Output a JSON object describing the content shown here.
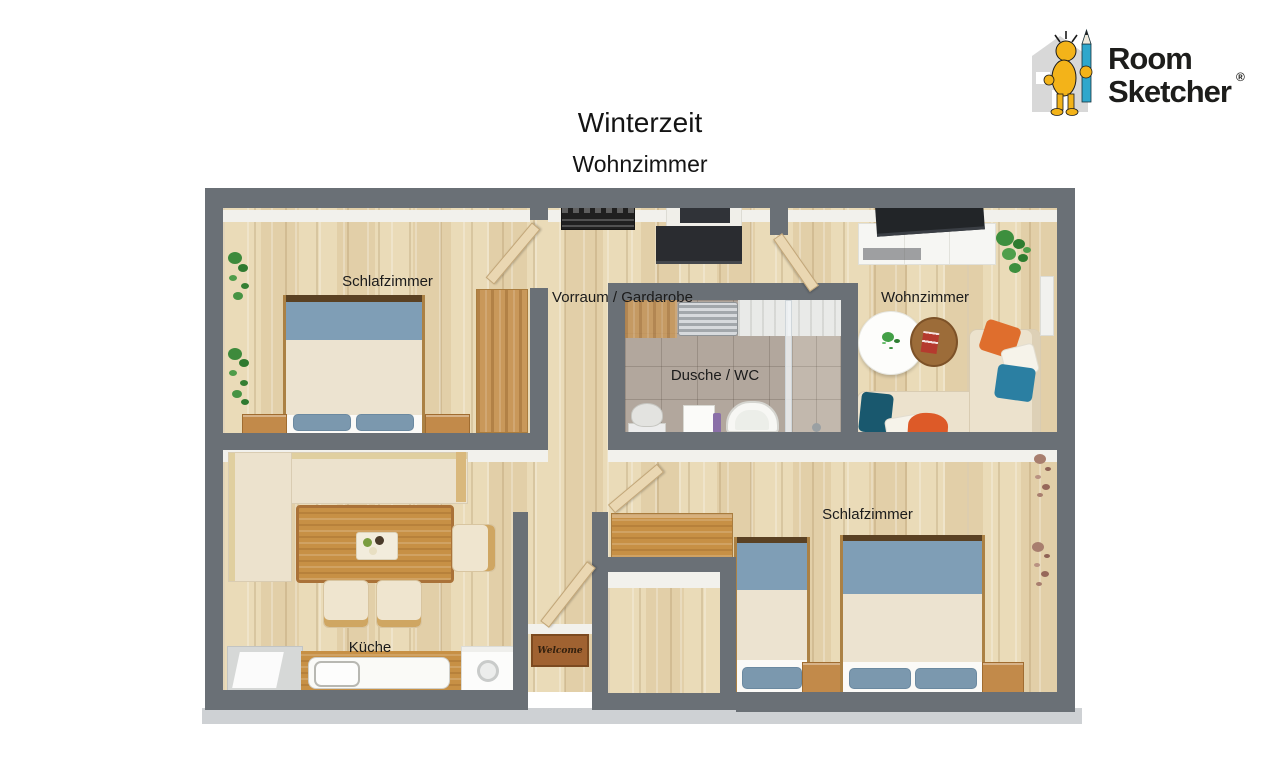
{
  "title": "Winterzeit",
  "subtitle": "Wohnzimmer",
  "logo": {
    "word1": "Room",
    "word2": "Sketcher",
    "registered": "®"
  },
  "rooms": {
    "bedroom_top_left": "Schlafzimmer",
    "hallway": "Vorraum / Gardarobe",
    "living_room": "Wohnzimmer",
    "bathroom": "Dusche / WC",
    "bedroom_bottom_right": "Schlafzimmer",
    "kitchen": "Küche"
  },
  "entrance_mat": "Welcome",
  "palette": {
    "wall_gray": "#6a7076",
    "floor_wood": "#e7d6b2",
    "bathroom_tile": "#b2a79d",
    "bed_blanket_blue": "#7f9eb6",
    "mattress_cream": "#ece3d0",
    "sofa_cream": "#ece2cd",
    "pillow_orange": "#df6e2d",
    "pillow_teal": "#2b7fa2",
    "furniture_wood": "#c79045",
    "mat_brown": "#a06231",
    "logo_yellow": "#f3b319",
    "logo_pencil_blue": "#2fa7cc"
  }
}
